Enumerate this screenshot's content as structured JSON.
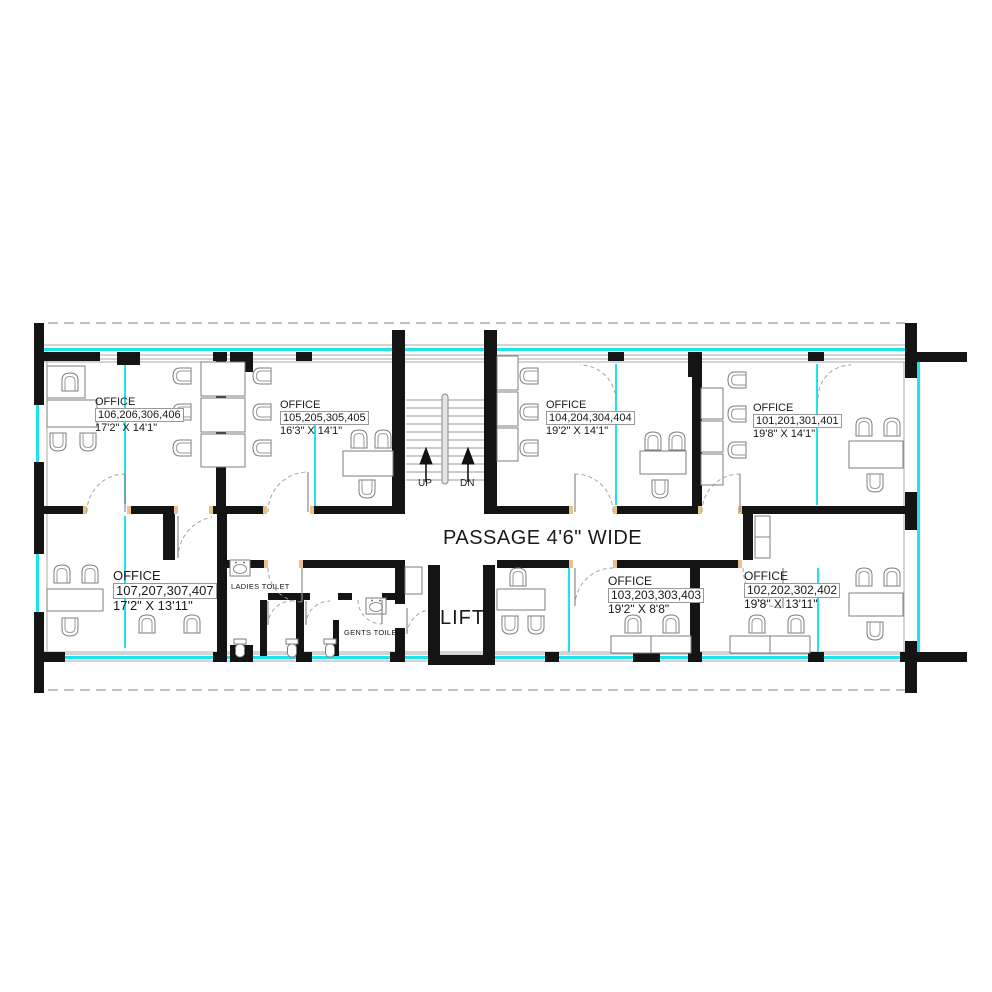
{
  "plan": {
    "passage_label": "PASSAGE 4'6\" WIDE",
    "lift_label": "LIFT",
    "stairs": {
      "up_label": "UP",
      "dn_label": "DN"
    },
    "toilets": {
      "ladies_label": "LADIES TOILET",
      "gents_label": "GENTS TOILET"
    },
    "offices": [
      {
        "title": "OFFICE",
        "numbers": "106,206,306,406",
        "size": "17'2\" X 14'1\""
      },
      {
        "title": "OFFICE",
        "numbers": "105,205,305,405",
        "size": "16'3\" X 14'1\""
      },
      {
        "title": "OFFICE",
        "numbers": "104,204,304,404",
        "size": "19'2\" X 14'1\""
      },
      {
        "title": "OFFICE",
        "numbers": "101,201,301,401",
        "size": "19'8\" X 14'1\""
      },
      {
        "title": "OFFICE",
        "numbers": "107,207,307,407",
        "size": "17'2\" X 13'11\""
      },
      {
        "title": "OFFICE",
        "numbers": "103,203,303,403",
        "size": "19'2\" X 8'8\""
      },
      {
        "title": "OFFICE",
        "numbers": "102,202,302,402",
        "size": "19'8\" X 13'11\""
      }
    ],
    "colors": {
      "wall": "#141414",
      "glass": "#1ee3ec",
      "jamb": "#eac08e",
      "line": "#8a8a8a"
    }
  }
}
